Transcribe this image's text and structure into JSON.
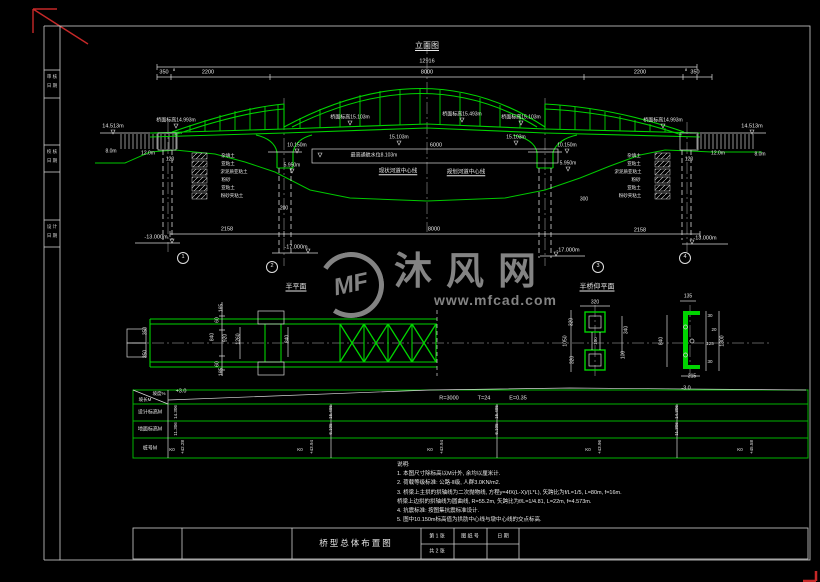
{
  "watermark": {
    "logo": "MF",
    "name": "沐风网",
    "url": "www.mfcad.com"
  },
  "title_block": {
    "drawing_title": "桥型总体布置图",
    "sheet_no": "第 1 张",
    "sheet_total": "共 2 张",
    "drawing_no_label": "图 纸 号",
    "date_label": "日 期"
  },
  "frame": {
    "stamps": [
      {
        "l1": "审 核",
        "l2": "日 期",
        "y": 72
      },
      {
        "l1": "校 核",
        "l2": "日 期",
        "y": 147
      },
      {
        "l1": "设 计",
        "l2": "日 期",
        "y": 222
      }
    ]
  },
  "table": {
    "header_slope_top": "坡度%",
    "header_slope_bottom": "坡长M",
    "header_design": "设计标高M",
    "header_ground": "地面标高M",
    "header_station": "桩号M"
  },
  "notes": {
    "lines": [
      "说明:",
      "1. 本图尺寸除标高以M计外, 余均以厘米计.",
      "2. 荷载等级标准: 公路-Ⅱ级, 人群3.0KN/m2.",
      "3. 桥梁上主拱的拱轴线为二次抛物线, 方程y=4fX(L-X)/(L*L), 矢跨比为f/L=1/5, L=80m, f=16m.",
      "    桥梁上边拱的拱轴线为圆曲线, R=55.2m, 矢跨比为f/L=1/4.81, L=22m, f=4.573m.",
      "4. 抗震标准: 按图集抗震标准设计.",
      "5. 图中10.150m标高值为拱肋中心线与墩中心线的交点标高."
    ]
  },
  "annotations": [
    {
      "n": "view-title-elevation",
      "t": "立面图",
      "x": 427,
      "y": 46,
      "s": 8,
      "u": 1
    },
    {
      "n": "dim-label",
      "t": "12916",
      "x": 427,
      "y": 62,
      "s": 5.5
    },
    {
      "n": "dim-label",
      "t": "350",
      "x": 164,
      "y": 73,
      "s": 5.5
    },
    {
      "n": "dim-label",
      "t": "8",
      "x": 174,
      "y": 70,
      "s": 4
    },
    {
      "n": "dim-label",
      "t": "2200",
      "x": 208,
      "y": 73,
      "s": 5.5
    },
    {
      "n": "dim-label",
      "t": "8000",
      "x": 427,
      "y": 73,
      "s": 5.5
    },
    {
      "n": "dim-label",
      "t": "2200",
      "x": 640,
      "y": 73,
      "s": 5.5
    },
    {
      "n": "dim-label",
      "t": "8",
      "x": 686,
      "y": 70,
      "s": 4
    },
    {
      "n": "dim-label",
      "t": "350",
      "x": 695,
      "y": 73,
      "s": 5.5
    },
    {
      "n": "elevation-label",
      "t": "14.513m",
      "x": 113,
      "y": 127,
      "s": 5.5
    },
    {
      "n": "elevation-label",
      "t": "桥面标高14.993m",
      "x": 176,
      "y": 121,
      "s": 5
    },
    {
      "n": "elevation-label",
      "t": "桥面标高15.103m",
      "x": 350,
      "y": 118,
      "s": 5
    },
    {
      "n": "elevation-label",
      "t": "桥面标高15.493m",
      "x": 462,
      "y": 115,
      "s": 5
    },
    {
      "n": "elevation-label",
      "t": "桥面标高15.103m",
      "x": 521,
      "y": 118,
      "s": 5
    },
    {
      "n": "elevation-label",
      "t": "桥面标高14.993m",
      "x": 663,
      "y": 121,
      "s": 5
    },
    {
      "n": "elevation-label",
      "t": "14.513m",
      "x": 752,
      "y": 127,
      "s": 5.5
    },
    {
      "n": "elevation-label",
      "t": "15.103m",
      "x": 399,
      "y": 138,
      "s": 5
    },
    {
      "n": "elevation-label",
      "t": "15.103m",
      "x": 516,
      "y": 138,
      "s": 5
    },
    {
      "n": "dim-label",
      "t": "6000",
      "x": 436,
      "y": 146,
      "s": 5.5
    },
    {
      "n": "elevation-label",
      "t": "10.150m",
      "x": 297,
      "y": 146,
      "s": 5
    },
    {
      "n": "elevation-label",
      "t": "10.150m",
      "x": 567,
      "y": 146,
      "s": 5
    },
    {
      "n": "elevation-label",
      "t": "5.950m",
      "x": 292,
      "y": 166,
      "s": 5
    },
    {
      "n": "elevation-label",
      "t": "5.950m",
      "x": 568,
      "y": 164,
      "s": 5
    },
    {
      "n": "water-level-label",
      "t": "最高通航水位8.103m",
      "x": 374,
      "y": 156,
      "s": 5
    },
    {
      "n": "centerline-label",
      "t": "现状河道中心线",
      "x": 398,
      "y": 172,
      "s": 5.5,
      "u": 1
    },
    {
      "n": "centerline-label",
      "t": "规划河道中心线",
      "x": 466,
      "y": 173,
      "s": 5.5,
      "u": 1
    },
    {
      "n": "elevation-label",
      "t": "12.0m",
      "x": 148,
      "y": 154,
      "s": 5
    },
    {
      "n": "elevation-label",
      "t": "8.0m",
      "x": 111,
      "y": 152,
      "s": 5
    },
    {
      "n": "elevation-label",
      "t": "12.0m",
      "x": 718,
      "y": 154,
      "s": 5
    },
    {
      "n": "elevation-label",
      "t": "8.0m",
      "x": 760,
      "y": 155,
      "s": 5
    },
    {
      "n": "dim-label",
      "t": "120",
      "x": 170,
      "y": 160,
      "s": 5
    },
    {
      "n": "dim-label",
      "t": "120",
      "x": 689,
      "y": 160,
      "s": 5
    },
    {
      "n": "dim-label",
      "t": "200",
      "x": 284,
      "y": 209,
      "s": 5
    },
    {
      "n": "dim-label",
      "t": "300",
      "x": 584,
      "y": 200,
      "s": 5
    },
    {
      "n": "elevation-label",
      "t": "-13.000m",
      "x": 156,
      "y": 238,
      "s": 5.5
    },
    {
      "n": "dim-label",
      "t": "2158",
      "x": 227,
      "y": 230,
      "s": 5.5
    },
    {
      "n": "elevation-label",
      "t": "-17.000m",
      "x": 296,
      "y": 248,
      "s": 5.5
    },
    {
      "n": "dim-label",
      "t": "8000",
      "x": 434,
      "y": 230,
      "s": 5.5
    },
    {
      "n": "elevation-label",
      "t": "-17.000m",
      "x": 568,
      "y": 251,
      "s": 5.5
    },
    {
      "n": "dim-label",
      "t": "2158",
      "x": 640,
      "y": 231,
      "s": 5.5
    },
    {
      "n": "elevation-label",
      "t": "-13.000m",
      "x": 705,
      "y": 239,
      "s": 5.5
    },
    {
      "n": "support-number",
      "t": "1",
      "x": 183,
      "y": 258,
      "c": 1
    },
    {
      "n": "support-number",
      "t": "2",
      "x": 272,
      "y": 267,
      "c": 1
    },
    {
      "n": "support-number",
      "t": "3",
      "x": 598,
      "y": 267,
      "c": 1
    },
    {
      "n": "support-number",
      "t": "4",
      "x": 685,
      "y": 258,
      "c": 1
    },
    {
      "n": "view-title-half-plan",
      "t": "半平面",
      "x": 296,
      "y": 287,
      "s": 7,
      "u": 1
    },
    {
      "n": "view-title-half-bottom-plan",
      "t": "半桥仰平面",
      "x": 597,
      "y": 287,
      "s": 7,
      "u": 1
    },
    {
      "n": "dim-label",
      "t": "135",
      "x": 688,
      "y": 297,
      "s": 5
    },
    {
      "n": "soil-layer-label",
      "t": "杂填土",
      "x": 228,
      "y": 156,
      "s": 4.5
    },
    {
      "n": "soil-layer-label",
      "t": "亚粘土",
      "x": 228,
      "y": 164,
      "s": 4.5
    },
    {
      "n": "soil-layer-label",
      "t": "淤泥质亚粘土",
      "x": 234,
      "y": 172,
      "s": 4.5
    },
    {
      "n": "soil-layer-label",
      "t": "粉砂",
      "x": 226,
      "y": 180,
      "s": 4.5
    },
    {
      "n": "soil-layer-label",
      "t": "亚粘土",
      "x": 228,
      "y": 188,
      "s": 4.5
    },
    {
      "n": "soil-layer-label",
      "t": "粉砂夹粘土",
      "x": 232,
      "y": 196,
      "s": 4.5
    },
    {
      "n": "soil-layer-label",
      "t": "杂填土",
      "x": 634,
      "y": 156,
      "s": 4.5
    },
    {
      "n": "soil-layer-label",
      "t": "亚粘土",
      "x": 634,
      "y": 164,
      "s": 4.5
    },
    {
      "n": "soil-layer-label",
      "t": "淤泥质亚粘土",
      "x": 628,
      "y": 172,
      "s": 4.5
    },
    {
      "n": "soil-layer-label",
      "t": "粉砂",
      "x": 636,
      "y": 180,
      "s": 4.5
    },
    {
      "n": "soil-layer-label",
      "t": "亚粘土",
      "x": 634,
      "y": 188,
      "s": 4.5
    },
    {
      "n": "soil-layer-label",
      "t": "粉砂夹粘土",
      "x": 630,
      "y": 196,
      "s": 4.5
    },
    {
      "n": "dim-label",
      "t": "350",
      "x": 146,
      "y": 331,
      "s": 5,
      "r": 1
    },
    {
      "n": "dim-label",
      "t": "350",
      "x": 146,
      "y": 354,
      "s": 5,
      "r": 1
    },
    {
      "n": "dim-label",
      "t": "165",
      "x": 222,
      "y": 308,
      "s": 5,
      "r": 1
    },
    {
      "n": "dim-label",
      "t": "60",
      "x": 218,
      "y": 320,
      "s": 5,
      "r": 1
    },
    {
      "n": "dim-label",
      "t": "840",
      "x": 213,
      "y": 337,
      "s": 5,
      "r": 1
    },
    {
      "n": "dim-label",
      "t": "920",
      "x": 226,
      "y": 338,
      "s": 5,
      "r": 1
    },
    {
      "n": "dim-label",
      "t": "1260",
      "x": 239,
      "y": 339,
      "s": 5,
      "r": 1
    },
    {
      "n": "dim-label",
      "t": "60",
      "x": 218,
      "y": 364,
      "s": 5,
      "r": 1
    },
    {
      "n": "dim-label",
      "t": "165",
      "x": 222,
      "y": 372,
      "s": 5,
      "r": 1
    },
    {
      "n": "dim-label",
      "t": "840",
      "x": 288,
      "y": 339,
      "s": 5,
      "r": 1
    },
    {
      "n": "dim-label",
      "t": "320",
      "x": 595,
      "y": 303,
      "s": 5
    },
    {
      "n": "dim-label",
      "t": "320",
      "x": 572,
      "y": 322,
      "s": 5,
      "r": 1
    },
    {
      "n": "dim-label",
      "t": "1050",
      "x": 566,
      "y": 341,
      "s": 5,
      "r": 1
    },
    {
      "n": "dim-label",
      "t": "320",
      "x": 573,
      "y": 360,
      "s": 5,
      "r": 1
    },
    {
      "n": "dim-label",
      "t": "100",
      "x": 596,
      "y": 341,
      "s": 4.5,
      "r": 1
    },
    {
      "n": "dim-label",
      "t": "340",
      "x": 627,
      "y": 330,
      "s": 5,
      "r": 1
    },
    {
      "n": "dim-label",
      "t": "100",
      "x": 624,
      "y": 355,
      "s": 5,
      "r": 1
    },
    {
      "n": "dim-label",
      "t": "840",
      "x": 662,
      "y": 341,
      "s": 5,
      "r": 1
    },
    {
      "n": "dim-label",
      "t": "1300",
      "x": 723,
      "y": 341,
      "s": 5,
      "r": 1
    },
    {
      "n": "dim-label",
      "t": "30",
      "x": 710,
      "y": 316,
      "s": 4.5
    },
    {
      "n": "dim-label",
      "t": "20",
      "x": 714,
      "y": 330,
      "s": 4.5
    },
    {
      "n": "dim-label",
      "t": "125",
      "x": 710,
      "y": 344,
      "s": 4.5
    },
    {
      "n": "dim-label",
      "t": "30",
      "x": 710,
      "y": 362,
      "s": 4.5
    },
    {
      "n": "dim-label",
      "t": "215",
      "x": 692,
      "y": 377,
      "s": 5
    },
    {
      "n": "grade-label",
      "t": "+3.0",
      "x": 181,
      "y": 392,
      "s": 5.5
    },
    {
      "n": "grade-label",
      "t": "-3.0",
      "x": 686,
      "y": 389,
      "s": 5.5
    },
    {
      "n": "curve-param",
      "t": "R=3000",
      "x": 449,
      "y": 399,
      "s": 5.5
    },
    {
      "n": "curve-param",
      "t": "T=24",
      "x": 484,
      "y": 399,
      "s": 5.5
    },
    {
      "n": "curve-param",
      "t": "E=0.35",
      "x": 518,
      "y": 399,
      "s": 5.5
    },
    {
      "n": "design-elevation",
      "t": "14.306",
      "x": 176,
      "y": 412,
      "s": 4.5,
      "r": 1
    },
    {
      "n": "design-elevation",
      "t": "15.495",
      "x": 331,
      "y": 412,
      "s": 4.5,
      "r": 1
    },
    {
      "n": "design-elevation",
      "t": "15.495",
      "x": 497,
      "y": 412,
      "s": 4.5,
      "r": 1
    },
    {
      "n": "design-elevation",
      "t": "14.306",
      "x": 677,
      "y": 412,
      "s": 4.5,
      "r": 1
    },
    {
      "n": "ground-elevation",
      "t": "11.306",
      "x": 176,
      "y": 429,
      "s": 4.5,
      "r": 1
    },
    {
      "n": "ground-elevation",
      "t": "6.105",
      "x": 331,
      "y": 429,
      "s": 4.5,
      "r": 1
    },
    {
      "n": "ground-elevation",
      "t": "6.105",
      "x": 497,
      "y": 429,
      "s": 4.5,
      "r": 1
    },
    {
      "n": "ground-elevation",
      "t": "11.306",
      "x": 677,
      "y": 429,
      "s": 4.5,
      "r": 1
    },
    {
      "n": "station-label",
      "t": "K0",
      "x": 172,
      "y": 450,
      "s": 4.5
    },
    {
      "n": "station-label",
      "t": "+42.28",
      "x": 183,
      "y": 447,
      "s": 4.5,
      "r": 1
    },
    {
      "n": "station-label",
      "t": "K0",
      "x": 300,
      "y": 450,
      "s": 4.5
    },
    {
      "n": "station-label",
      "t": "+43.94",
      "x": 312,
      "y": 447,
      "s": 4.5,
      "r": 1
    },
    {
      "n": "station-label",
      "t": "K0",
      "x": 430,
      "y": 450,
      "s": 4.5
    },
    {
      "n": "station-label",
      "t": "+43.94",
      "x": 442,
      "y": 447,
      "s": 4.5,
      "r": 1
    },
    {
      "n": "station-label",
      "t": "K0",
      "x": 588,
      "y": 450,
      "s": 4.5
    },
    {
      "n": "station-label",
      "t": "+43.96",
      "x": 600,
      "y": 447,
      "s": 4.5,
      "r": 1
    },
    {
      "n": "station-label",
      "t": "K0",
      "x": 740,
      "y": 450,
      "s": 4.5
    },
    {
      "n": "station-label",
      "t": "+45.58",
      "x": 752,
      "y": 447,
      "s": 4.5,
      "r": 1
    }
  ]
}
